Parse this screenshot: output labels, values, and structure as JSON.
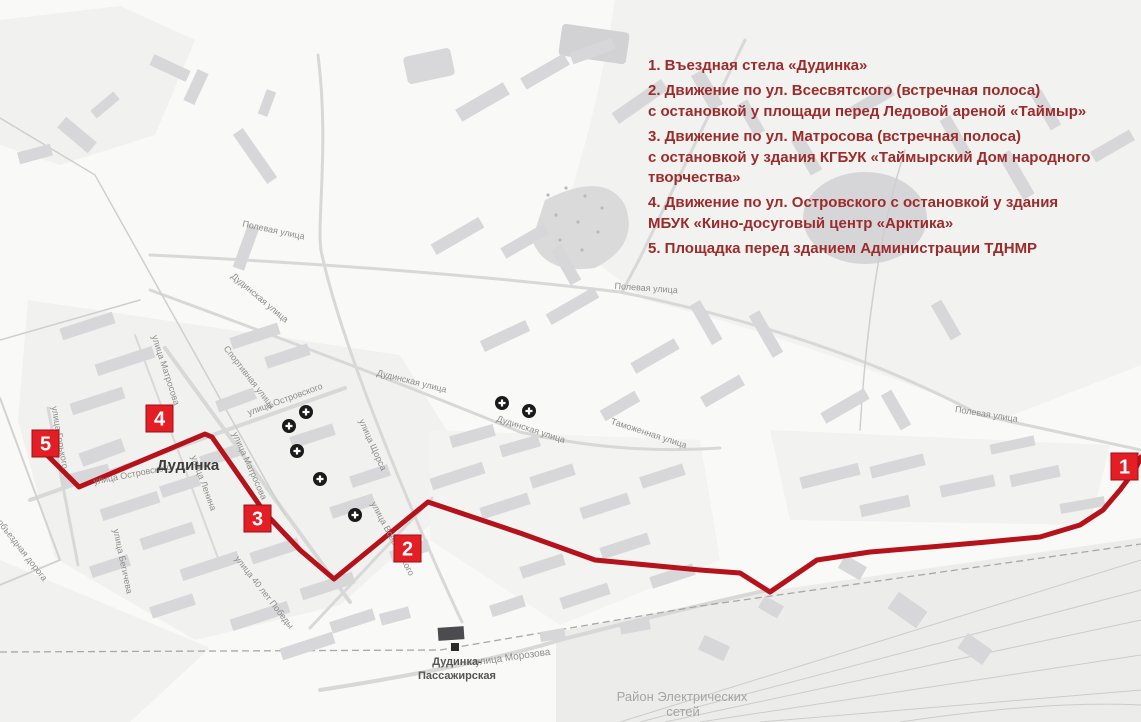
{
  "legend": {
    "text_color": "#9c2b2b",
    "items": [
      "1. Въездная стела «Дудинка»",
      "2. Движение по ул. Всесвятского (встречная полоса)\nс остановкой у площади перед Ледовой ареной «Таймыр»",
      "3. Движение по ул. Матросова (встречная полоса)\nс остановкой у здания КГБУК «Таймырский Дом народного\nтворчества»",
      "4. Движение по ул. Островского с остановкой у здания\nМБУК «Кино-досуговый центр «Арктика»",
      "5. Площадка перед зданием Администрации ТДНМР"
    ]
  },
  "map": {
    "city_label": "Дудинка",
    "station_label_line1": "Дудинка-",
    "station_label_line2": "Пассажирская",
    "area_label_line1": "Район Электрических",
    "area_label_line2": "сетей",
    "colors": {
      "route": "#b5121b",
      "marker_fill": "#e31e24",
      "marker_border": "#9e0f14",
      "marker_text": "#ffffff",
      "street_text": "#8d8d8d",
      "cross_icon": "#1a1a1a"
    },
    "route": {
      "width": 5,
      "points": [
        [
          42,
          450
        ],
        [
          79,
          487
        ],
        [
          205,
          434
        ],
        [
          212,
          437
        ],
        [
          265,
          513
        ],
        [
          300,
          550
        ],
        [
          334,
          579
        ],
        [
          428,
          502
        ],
        [
          520,
          533
        ],
        [
          595,
          560
        ],
        [
          700,
          570
        ],
        [
          740,
          573
        ],
        [
          770,
          592
        ],
        [
          817,
          560
        ],
        [
          870,
          552
        ],
        [
          930,
          547
        ],
        [
          987,
          542
        ],
        [
          1040,
          537
        ],
        [
          1080,
          525
        ],
        [
          1103,
          510
        ],
        [
          1120,
          490
        ],
        [
          1135,
          470
        ],
        [
          1141,
          457
        ]
      ]
    },
    "markers": [
      {
        "label": "1",
        "x": 1111,
        "y": 453
      },
      {
        "label": "2",
        "x": 394,
        "y": 535
      },
      {
        "label": "3",
        "x": 244,
        "y": 505
      },
      {
        "label": "4",
        "x": 146,
        "y": 405
      },
      {
        "label": "5",
        "x": 32,
        "y": 430
      }
    ],
    "street_labels": [
      {
        "text": "Полевая улица",
        "x": 273,
        "y": 233,
        "rot": 12,
        "size": 9
      },
      {
        "text": "Полевая улица",
        "x": 646,
        "y": 291,
        "rot": 4,
        "size": 9
      },
      {
        "text": "Полевая улица",
        "x": 986,
        "y": 417,
        "rot": 9,
        "size": 9
      },
      {
        "text": "Дудинская улица",
        "x": 258,
        "y": 300,
        "rot": 40,
        "size": 9
      },
      {
        "text": "Дудинская улица",
        "x": 411,
        "y": 384,
        "rot": 14,
        "size": 9
      },
      {
        "text": "Дудинская улица",
        "x": 530,
        "y": 432,
        "rot": 18,
        "size": 9
      },
      {
        "text": "Спортивная улица",
        "x": 247,
        "y": 379,
        "rot": 52,
        "size": 9
      },
      {
        "text": "улица Островского",
        "x": 286,
        "y": 402,
        "rot": -20,
        "size": 9
      },
      {
        "text": "улица Островского",
        "x": 133,
        "y": 477,
        "rot": -11,
        "size": 9
      },
      {
        "text": "улица Матросова",
        "x": 163,
        "y": 371,
        "rot": 72,
        "size": 9
      },
      {
        "text": "улица Матросова",
        "x": 247,
        "y": 467,
        "rot": 66,
        "size": 9
      },
      {
        "text": "улица Ленина",
        "x": 201,
        "y": 484,
        "rot": 70,
        "size": 9
      },
      {
        "text": "улица Горького",
        "x": 57,
        "y": 438,
        "rot": 80,
        "size": 9
      },
      {
        "text": "улица Бегичева",
        "x": 120,
        "y": 562,
        "rot": 78,
        "size": 9
      },
      {
        "text": "объездная дорога",
        "x": 20,
        "y": 552,
        "rot": 52,
        "size": 9
      },
      {
        "text": "улица 40 лет Победы",
        "x": 262,
        "y": 594,
        "rot": 52,
        "size": 9
      },
      {
        "text": "улица Всесвятского",
        "x": 390,
        "y": 540,
        "rot": 62,
        "size": 9
      },
      {
        "text": "улица Щорса",
        "x": 370,
        "y": 446,
        "rot": 66,
        "size": 9
      },
      {
        "text": "Таможенная улица",
        "x": 648,
        "y": 436,
        "rot": 18,
        "size": 9
      },
      {
        "text": "улица Морозова",
        "x": 513,
        "y": 660,
        "rot": -8,
        "size": 10
      }
    ],
    "crosses": [
      [
        306,
        412
      ],
      [
        289,
        426
      ],
      [
        297,
        451
      ],
      [
        320,
        479
      ],
      [
        355,
        515
      ],
      [
        502,
        403
      ],
      [
        529,
        411
      ]
    ]
  }
}
